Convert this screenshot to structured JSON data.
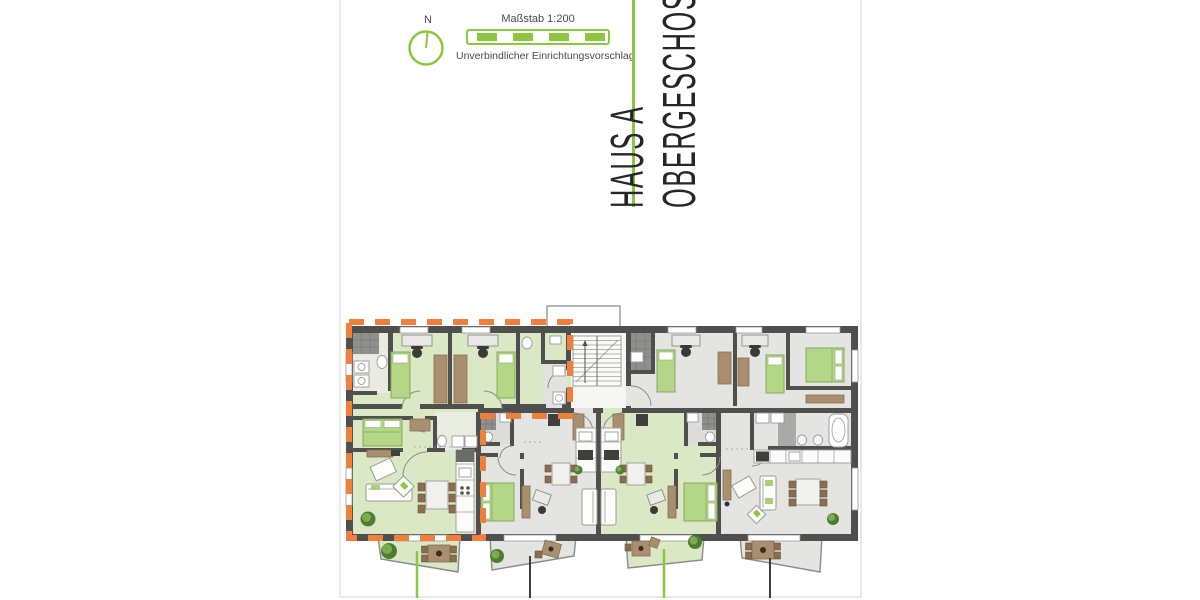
{
  "legend": {
    "north_label": "N",
    "scale_label": "Maßstab 1:200",
    "disclaimer": "Unverbindlicher Einrichtungsvorschlag"
  },
  "title": {
    "line1": "HAUS A",
    "line2": "OBERGESCHOSS"
  },
  "colors": {
    "accent_green": "#8dc63f",
    "highlight_orange": "#ef7f3c",
    "wall": "#4f4f4d",
    "floor_green": "#dbe8c6",
    "floor_gray": "#e4e4e2",
    "stair_floor": "#f6f6f4",
    "bed_green": "#b4d687",
    "furniture_brown": "#a98e6f",
    "tile_dark": "#8f8f8d",
    "leader_dark": "#3e3e3c",
    "page_edge": "#dcdcdc",
    "outline_gray": "#9a9a98"
  }
}
